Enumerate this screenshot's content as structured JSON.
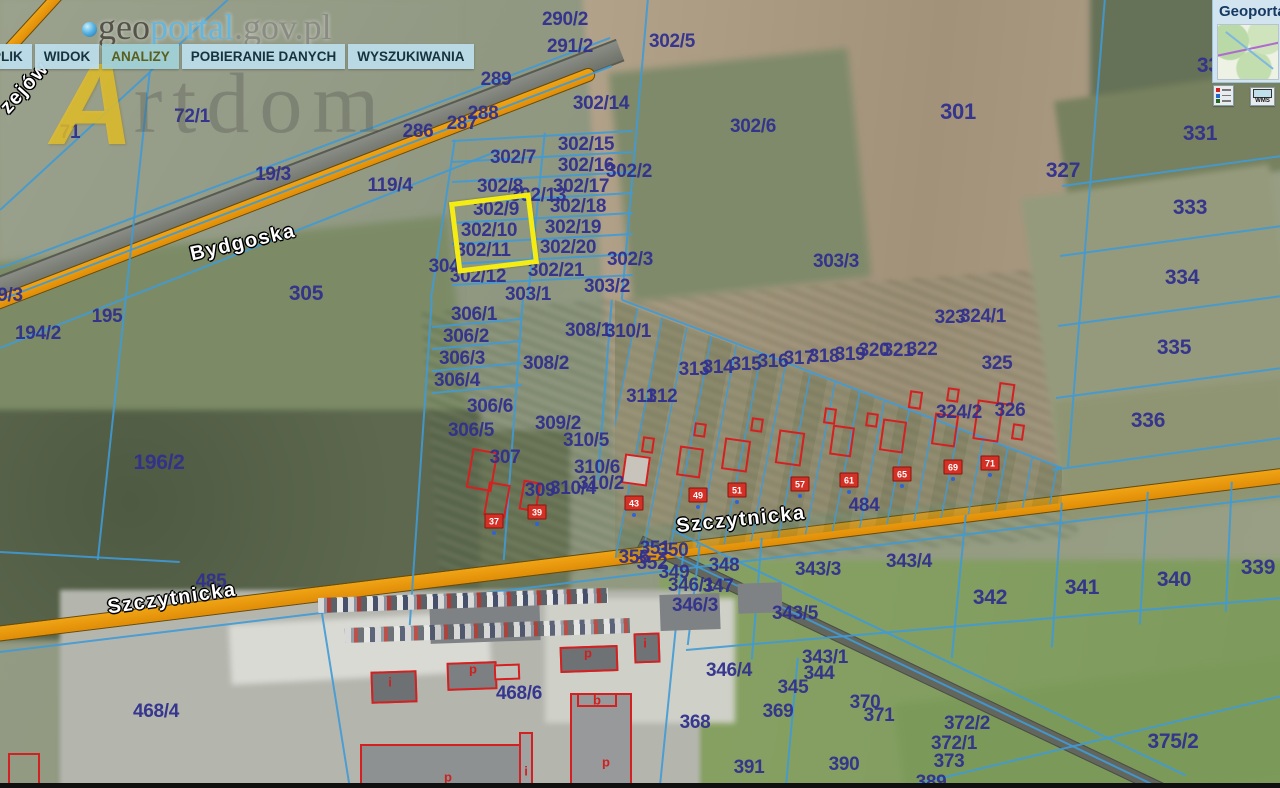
{
  "app": {
    "logo": {
      "part1": "geo",
      "part2": "portal",
      "part3": ".gov.pl"
    },
    "menu": [
      "PLIK",
      "WIDOK",
      "ANALIZY",
      "POBIERANIE DANYCH",
      "WYSZUKIWANIA"
    ],
    "active_menu": "ANALIZY",
    "watermark": {
      "initial": "A",
      "text": "rtdom"
    }
  },
  "panel": {
    "title": "Geoporta",
    "wms_label": "WMS"
  },
  "map": {
    "colors": {
      "road": "#e8950c",
      "boundary": "#3f9ad6",
      "parcel_text": "#31308e",
      "highlight": "#f4ec12",
      "building_outline": "#d42020"
    },
    "highlighted_parcel": "302/10",
    "streets": [
      {
        "t": "Bydgoska",
        "x": 243,
        "y": 243,
        "r": -13
      },
      {
        "t": "Szczytnicka",
        "x": 172,
        "y": 599,
        "r": -8
      },
      {
        "t": "Szczytnicka",
        "x": 741,
        "y": 520,
        "r": -6
      },
      {
        "t": "zejów",
        "x": 25,
        "y": 88,
        "r": -48
      }
    ],
    "parcels": [
      {
        "t": "290/2",
        "x": 565,
        "y": 20
      },
      {
        "t": "291/2",
        "x": 570,
        "y": 47
      },
      {
        "t": "302/5",
        "x": 672,
        "y": 42
      },
      {
        "t": "289",
        "x": 496,
        "y": 80
      },
      {
        "t": "302/14",
        "x": 601,
        "y": 104
      },
      {
        "t": "288",
        "x": 483,
        "y": 114
      },
      {
        "t": "287",
        "x": 462,
        "y": 124
      },
      {
        "t": "286",
        "x": 418,
        "y": 132
      },
      {
        "t": "71",
        "x": 70,
        "y": 133
      },
      {
        "t": "72/1",
        "x": 192,
        "y": 117
      },
      {
        "t": "19/3",
        "x": 273,
        "y": 175
      },
      {
        "t": "119/4",
        "x": 390,
        "y": 186
      },
      {
        "t": "302/6",
        "x": 753,
        "y": 127
      },
      {
        "t": "301",
        "x": 958,
        "y": 112,
        "fs": 22
      },
      {
        "t": "327",
        "x": 1063,
        "y": 171,
        "fs": 21
      },
      {
        "t": "330",
        "x": 1214,
        "y": 66,
        "fs": 21
      },
      {
        "t": "331",
        "x": 1200,
        "y": 134,
        "fs": 21
      },
      {
        "t": "333",
        "x": 1190,
        "y": 208,
        "fs": 21
      },
      {
        "t": "334",
        "x": 1182,
        "y": 278,
        "fs": 21
      },
      {
        "t": "335",
        "x": 1174,
        "y": 348,
        "fs": 21
      },
      {
        "t": "336",
        "x": 1148,
        "y": 421,
        "fs": 21
      },
      {
        "t": "302/7",
        "x": 513,
        "y": 158
      },
      {
        "t": "302/15",
        "x": 586,
        "y": 145
      },
      {
        "t": "302/16",
        "x": 586,
        "y": 166
      },
      {
        "t": "302/2",
        "x": 629,
        "y": 172
      },
      {
        "t": "302/8",
        "x": 500,
        "y": 187
      },
      {
        "t": "302/17",
        "x": 581,
        "y": 187
      },
      {
        "t": "302/13",
        "x": 538,
        "y": 196
      },
      {
        "t": "302/9",
        "x": 496,
        "y": 210
      },
      {
        "t": "302/18",
        "x": 578,
        "y": 207
      },
      {
        "t": "302/10",
        "x": 489,
        "y": 231
      },
      {
        "t": "302/19",
        "x": 573,
        "y": 228
      },
      {
        "t": "302/11",
        "x": 483,
        "y": 251
      },
      {
        "t": "302/20",
        "x": 568,
        "y": 248
      },
      {
        "t": "302/3",
        "x": 630,
        "y": 260
      },
      {
        "t": "304",
        "x": 444,
        "y": 267
      },
      {
        "t": "302/21",
        "x": 556,
        "y": 271
      },
      {
        "t": "302/12",
        "x": 478,
        "y": 277
      },
      {
        "t": "303/2",
        "x": 607,
        "y": 287
      },
      {
        "t": "303/1",
        "x": 528,
        "y": 295
      },
      {
        "t": "303/3",
        "x": 836,
        "y": 262
      },
      {
        "t": "195",
        "x": 107,
        "y": 317
      },
      {
        "t": "194/2",
        "x": 38,
        "y": 334
      },
      {
        "t": "9/3",
        "x": 10,
        "y": 296
      },
      {
        "t": "305",
        "x": 306,
        "y": 294,
        "fs": 21
      },
      {
        "t": "306/1",
        "x": 474,
        "y": 315
      },
      {
        "t": "308/1",
        "x": 588,
        "y": 331
      },
      {
        "t": "310/1",
        "x": 628,
        "y": 332
      },
      {
        "t": "306/2",
        "x": 466,
        "y": 337
      },
      {
        "t": "306/3",
        "x": 462,
        "y": 359
      },
      {
        "t": "308/2",
        "x": 546,
        "y": 364
      },
      {
        "t": "306/4",
        "x": 457,
        "y": 381
      },
      {
        "t": "311",
        "x": 641,
        "y": 397
      },
      {
        "t": "312",
        "x": 662,
        "y": 397
      },
      {
        "t": "306/6",
        "x": 490,
        "y": 407
      },
      {
        "t": "309/2",
        "x": 558,
        "y": 424
      },
      {
        "t": "306/5",
        "x": 471,
        "y": 431
      },
      {
        "t": "310/5",
        "x": 586,
        "y": 441
      },
      {
        "t": "307",
        "x": 505,
        "y": 458
      },
      {
        "t": "310/6",
        "x": 597,
        "y": 468
      },
      {
        "t": "310/2",
        "x": 601,
        "y": 484
      },
      {
        "t": "309",
        "x": 540,
        "y": 491
      },
      {
        "t": "310/4",
        "x": 573,
        "y": 489
      },
      {
        "t": "313",
        "x": 694,
        "y": 370
      },
      {
        "t": "314",
        "x": 718,
        "y": 368
      },
      {
        "t": "315",
        "x": 746,
        "y": 365
      },
      {
        "t": "316",
        "x": 773,
        "y": 362
      },
      {
        "t": "317",
        "x": 799,
        "y": 359
      },
      {
        "t": "318",
        "x": 824,
        "y": 357
      },
      {
        "t": "319",
        "x": 850,
        "y": 355
      },
      {
        "t": "320",
        "x": 874,
        "y": 351
      },
      {
        "t": "321",
        "x": 898,
        "y": 351
      },
      {
        "t": "322",
        "x": 922,
        "y": 350
      },
      {
        "t": "323",
        "x": 950,
        "y": 318
      },
      {
        "t": "324/1",
        "x": 983,
        "y": 317
      },
      {
        "t": "325",
        "x": 997,
        "y": 364
      },
      {
        "t": "324/2",
        "x": 959,
        "y": 413
      },
      {
        "t": "326",
        "x": 1010,
        "y": 411
      },
      {
        "t": "484",
        "x": 864,
        "y": 506
      },
      {
        "t": "485",
        "x": 211,
        "y": 582
      },
      {
        "t": "351",
        "x": 655,
        "y": 549
      },
      {
        "t": "350",
        "x": 673,
        "y": 551
      },
      {
        "t": "356",
        "x": 634,
        "y": 558
      },
      {
        "t": "352",
        "x": 652,
        "y": 564
      },
      {
        "t": "349",
        "x": 674,
        "y": 573
      },
      {
        "t": "348",
        "x": 724,
        "y": 566
      },
      {
        "t": "343/3",
        "x": 818,
        "y": 570
      },
      {
        "t": "343/4",
        "x": 909,
        "y": 562
      },
      {
        "t": "342",
        "x": 990,
        "y": 598,
        "fs": 21
      },
      {
        "t": "341",
        "x": 1082,
        "y": 588,
        "fs": 21
      },
      {
        "t": "340",
        "x": 1174,
        "y": 580,
        "fs": 21
      },
      {
        "t": "339",
        "x": 1258,
        "y": 568,
        "fs": 21
      },
      {
        "t": "346/1",
        "x": 691,
        "y": 586
      },
      {
        "t": "347",
        "x": 718,
        "y": 587
      },
      {
        "t": "346/3",
        "x": 695,
        "y": 606
      },
      {
        "t": "343/5",
        "x": 795,
        "y": 614
      },
      {
        "t": "343/1",
        "x": 825,
        "y": 658
      },
      {
        "t": "346/4",
        "x": 729,
        "y": 671
      },
      {
        "t": "344",
        "x": 819,
        "y": 674
      },
      {
        "t": "345",
        "x": 793,
        "y": 688
      },
      {
        "t": "370",
        "x": 865,
        "y": 703
      },
      {
        "t": "369",
        "x": 778,
        "y": 712
      },
      {
        "t": "371",
        "x": 879,
        "y": 716
      },
      {
        "t": "368",
        "x": 695,
        "y": 723
      },
      {
        "t": "372/2",
        "x": 967,
        "y": 724
      },
      {
        "t": "372/1",
        "x": 954,
        "y": 744
      },
      {
        "t": "373",
        "x": 949,
        "y": 762
      },
      {
        "t": "391",
        "x": 749,
        "y": 768
      },
      {
        "t": "390",
        "x": 844,
        "y": 765
      },
      {
        "t": "389",
        "x": 931,
        "y": 783
      },
      {
        "t": "375/2",
        "x": 1173,
        "y": 742,
        "fs": 21
      },
      {
        "t": "196/2",
        "x": 159,
        "y": 463,
        "fs": 21
      },
      {
        "t": "468/4",
        "x": 156,
        "y": 712
      },
      {
        "t": "468/6",
        "x": 519,
        "y": 694
      }
    ],
    "addresses": [
      {
        "t": "37",
        "x": 494,
        "y": 521
      },
      {
        "t": "39",
        "x": 537,
        "y": 512
      },
      {
        "t": "43",
        "x": 634,
        "y": 503
      },
      {
        "t": "49",
        "x": 698,
        "y": 495
      },
      {
        "t": "51",
        "x": 737,
        "y": 490
      },
      {
        "t": "57",
        "x": 800,
        "y": 484
      },
      {
        "t": "61",
        "x": 849,
        "y": 480
      },
      {
        "t": "65",
        "x": 902,
        "y": 474
      },
      {
        "t": "69",
        "x": 953,
        "y": 467
      },
      {
        "t": "71",
        "x": 990,
        "y": 463
      }
    ],
    "building_letters": [
      {
        "t": "i",
        "x": 390,
        "y": 682
      },
      {
        "t": "p",
        "x": 473,
        "y": 669
      },
      {
        "t": "p",
        "x": 588,
        "y": 653
      },
      {
        "t": "i",
        "x": 645,
        "y": 643
      },
      {
        "t": "b",
        "x": 597,
        "y": 700
      },
      {
        "t": "p",
        "x": 448,
        "y": 777
      },
      {
        "t": "i",
        "x": 526,
        "y": 771
      },
      {
        "t": "p",
        "x": 606,
        "y": 762
      }
    ]
  }
}
